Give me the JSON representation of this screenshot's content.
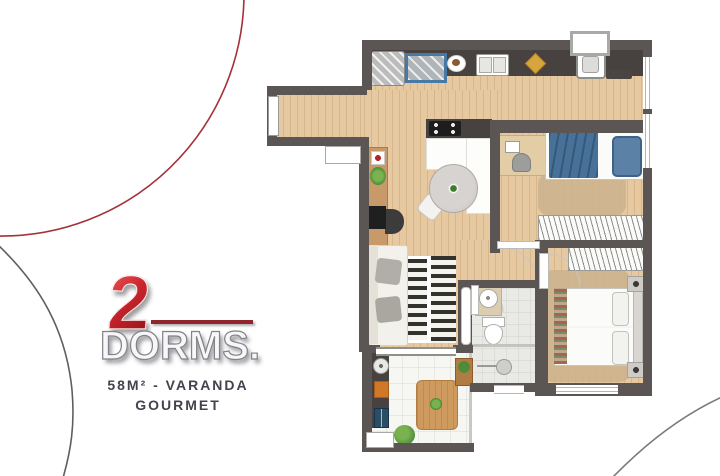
{
  "badge": {
    "number": "2",
    "word": "DORMS.",
    "area_line1": "58M² - VARANDA",
    "area_line2": "GOURMET"
  },
  "colors": {
    "accent_red": "#c8242b",
    "underline_red": "#8e262c",
    "subtitle_text": "#42434d",
    "wall": "#5b5653",
    "wood_floor": "#e7c9a1",
    "counter_dark": "#474140",
    "bed_blue": "#48719a",
    "rug_tan": "#cdb48e",
    "grill_orange": "#d07828"
  },
  "floorplan": {
    "type": "apartment-floor-plan",
    "rooms": [
      "entry-corridor",
      "kitchen",
      "service-area",
      "living-dining",
      "bedroom-2",
      "master-bedroom",
      "bathroom",
      "varanda-gourmet"
    ],
    "features": [
      "entry-door",
      "kitchen-counter",
      "refrigerator",
      "cooktop",
      "double-sink",
      "laundry-tub",
      "dining-table",
      "sofa",
      "tv-console",
      "striped-rug",
      "desk",
      "single-bed",
      "wardrobes",
      "double-bed",
      "nightstands",
      "bathroom-sink",
      "toilet",
      "shower",
      "barbecue-grill",
      "varanda-table",
      "plants",
      "sliding-door",
      "windows"
    ]
  }
}
